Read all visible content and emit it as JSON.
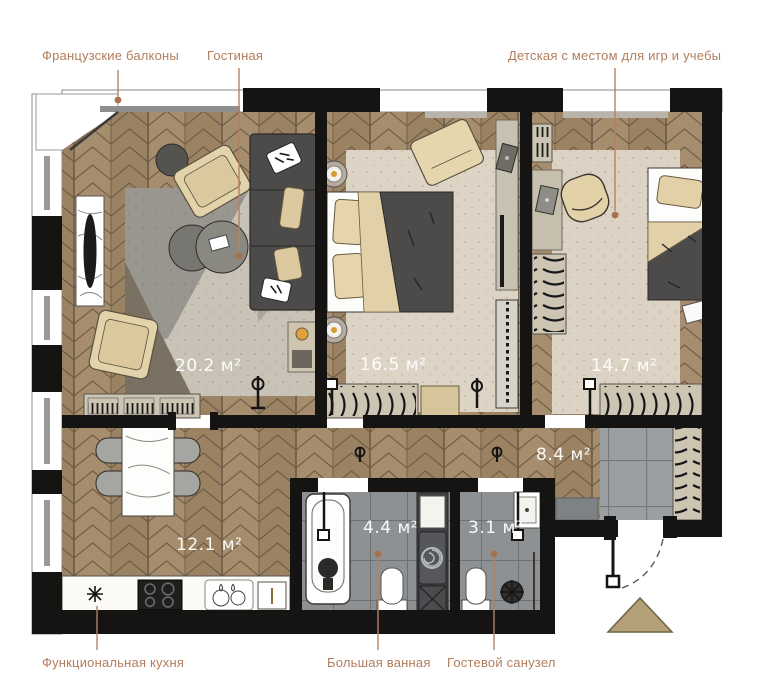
{
  "callouts": {
    "french_balconies": {
      "label": "Французские балконы"
    },
    "living_room": {
      "label": "Гостиная"
    },
    "kids_room": {
      "label": "Детская с местом для игр и учебы"
    },
    "kitchen": {
      "label": "Функциональная кухня"
    },
    "bathroom": {
      "label": "Большая ванная"
    },
    "guest_wc": {
      "label": "Гостевой санузел"
    }
  },
  "areas": {
    "living": "20.2 м²",
    "bedroom": "16.5 м²",
    "kids": "14.7 м²",
    "hall": "8.4 м²",
    "kitchen": "12.1 м²",
    "bath": "4.4 м²",
    "wc": "3.1 м²"
  },
  "colors": {
    "accent_label": "#b17e5d",
    "wall": "#151413",
    "floor_wood": "#a38b6b",
    "tile": "#8d9193",
    "furniture_dark": "#4c4b4a",
    "furniture_cream": "#e3d3ab",
    "entrance_marker": "#b3a077"
  }
}
